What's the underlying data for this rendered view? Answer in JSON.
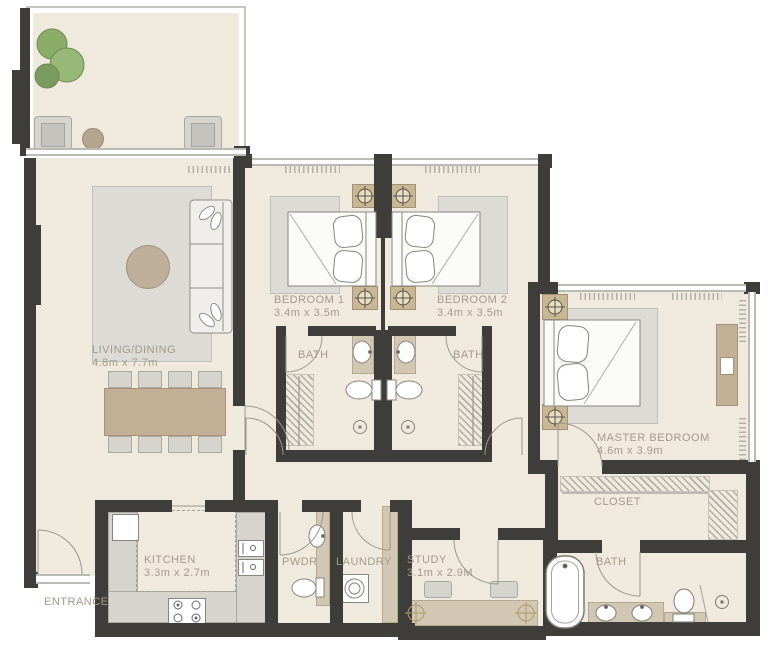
{
  "rooms": {
    "living": {
      "label": "LIVING/DINING",
      "dims": "4.8m x 7.7m"
    },
    "bedroom1": {
      "label": "BEDROOM 1",
      "dims": "3.4m x 3.5m"
    },
    "bedroom2": {
      "label": "BEDROOM 2",
      "dims": "3.4m x 3.5m"
    },
    "master": {
      "label": "MASTER BEDROOM",
      "dims": "4.6m x 3.9m"
    },
    "bath1": {
      "label": "BATH"
    },
    "bath2": {
      "label": "BATH"
    },
    "master_bath": {
      "label": "BATH"
    },
    "closet": {
      "label": "CLOSET"
    },
    "kitchen": {
      "label": "KITCHEN",
      "dims": "3.3m x 2.7m"
    },
    "pwdr": {
      "label": "PWDR"
    },
    "laundry": {
      "label": "LAUNDRY"
    },
    "study": {
      "label": "STUDY",
      "dims": "3.1m x 2.9M"
    },
    "entrance": {
      "label": "ENTRANCE"
    }
  },
  "colors": {
    "wall": "#3e3d3a",
    "floor": "#f0eade",
    "window_line": "#bcbab5",
    "rug_gray": "#dcdbd5",
    "accent_tan": "#c2b096",
    "counter_tan": "#d2c7b3",
    "furniture_gray": "#d6d4cd",
    "plant_green": "#86aa64",
    "label_text": "#a49a89"
  }
}
